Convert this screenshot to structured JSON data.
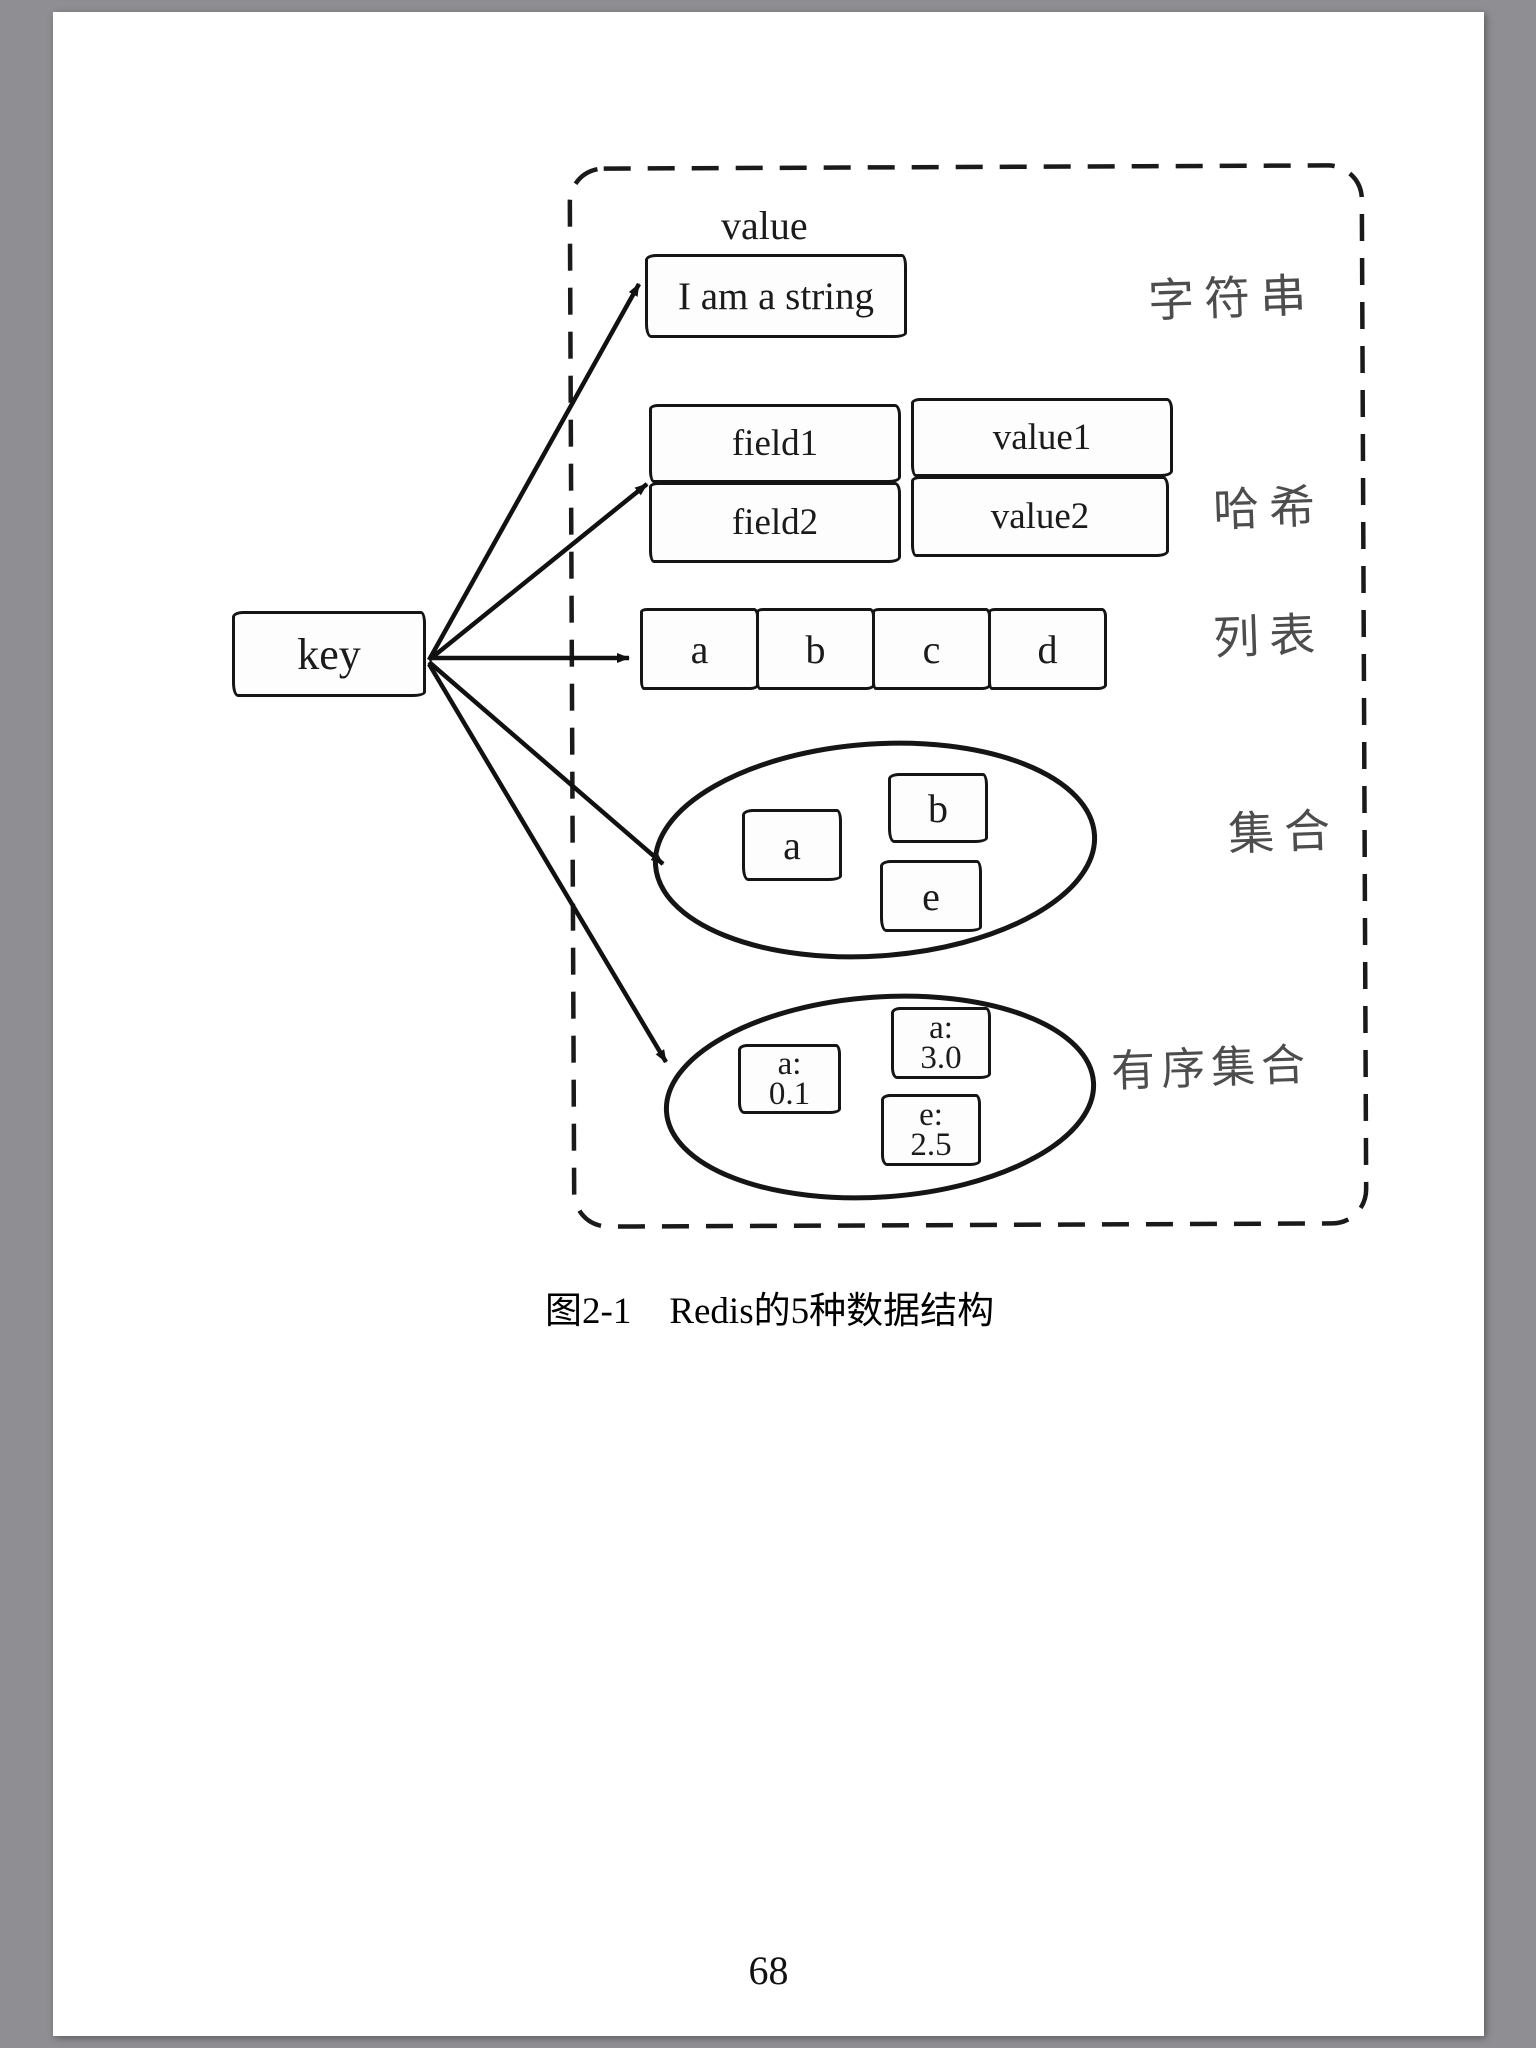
{
  "page": {
    "number": "68",
    "caption": {
      "figure_label": "图2-1",
      "figure_title": "Redis的5种数据结构"
    }
  },
  "diagram": {
    "key_label": "key",
    "value_label": "value",
    "string": {
      "text": "I am a string",
      "category": "字符串"
    },
    "hash": {
      "category": "哈希",
      "rows": [
        [
          "field1",
          "value1"
        ],
        [
          "field2",
          "value2"
        ]
      ]
    },
    "list": {
      "category": "列表",
      "items": [
        "a",
        "b",
        "c",
        "d"
      ]
    },
    "set": {
      "category": "集合",
      "items": [
        "a",
        "b",
        "e"
      ]
    },
    "sorted_set": {
      "category": "有序集合",
      "items": [
        {
          "member": "a:",
          "score": "0.1"
        },
        {
          "member": "a:",
          "score": "3.0"
        },
        {
          "member": "e:",
          "score": "2.5"
        }
      ]
    }
  },
  "colors": {
    "frame_background": "#8e8e93",
    "page_background": "#ffffff",
    "ink": "#151515",
    "pencil_label": "#4d4d4d"
  }
}
